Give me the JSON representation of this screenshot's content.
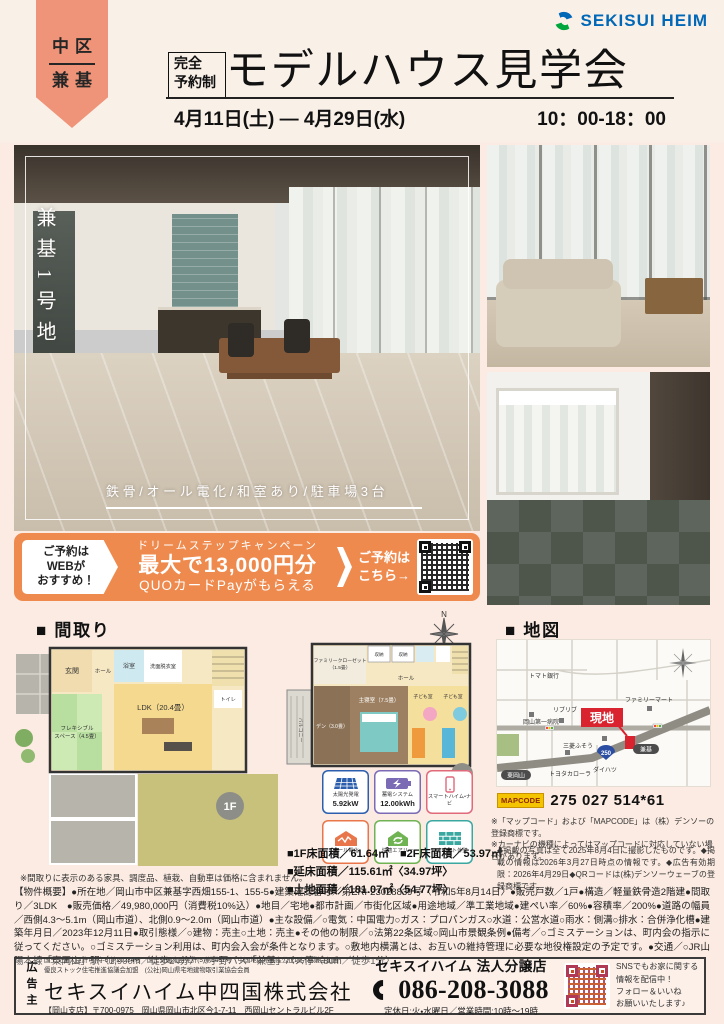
{
  "colors": {
    "accent_orange": "#ef8a4e",
    "ribbon": "#ef9478",
    "logo_blue": "#0068b7",
    "logo_green": "#00a63c",
    "map_red": "#d9232e",
    "mapcode_yellow": "#f5c400"
  },
  "header": {
    "area_badge": {
      "top": "中区",
      "bottom": "兼基"
    },
    "logo_text": "SEKISUI HEIM",
    "reserve_badge": {
      "top": "完全",
      "bottom": "予約制"
    },
    "title": "モデルハウス見学会",
    "date_range": "4月11日(土) ― 4月29日(水)",
    "time_range": "10：00-18：00"
  },
  "photos": {
    "site_label": "兼基1号地",
    "caption": "鉄骨/オール電化/和室あり/駐車場3台"
  },
  "campaign": {
    "web_lines": [
      "ご予約は",
      "WEBが",
      "おすすめ！"
    ],
    "subtitle": "ドリームステップキャンペーン",
    "headline": "最大で13,000円分",
    "subline": "QUOカードPayがもらえる",
    "cta_line1": "ご予約は",
    "cta_line2": "こちら→"
  },
  "madori": {
    "heading": "■ 間取り",
    "compass": "N",
    "f1": {
      "badge": "1F",
      "rooms": {
        "genkan": "玄関",
        "hall": "ホール",
        "bath": "浴室",
        "wash": "洗面脱衣室",
        "toilet": "トイレ",
        "ldk": "LDK（20.4畳）",
        "flex1": "フレキシブル",
        "flex2": "スペース（4.5畳）"
      }
    },
    "f2": {
      "badge": "2F",
      "rooms": {
        "balcony": "バルコニー",
        "fc1": "ファミリークローゼット",
        "fc2": "（1.5畳）",
        "den": "デン（3.0畳）",
        "bed": "主寝室（7.5畳）",
        "kids1": "子ども室",
        "kids2": "子ども室",
        "hall": "ホール",
        "closet1": "収納",
        "closet2": "収納"
      }
    },
    "features": [
      {
        "label": "太陽光発電",
        "value": "5.92kW"
      },
      {
        "label": "蓄電システム",
        "value": "12.00kWh"
      },
      {
        "label": "スマートハイム・ナビ",
        "value": ""
      },
      {
        "label": "オール電化",
        "value": ""
      },
      {
        "label": "快適エアリー",
        "value": ""
      },
      {
        "label": "ジオマイト外壁",
        "value": ""
      }
    ],
    "areas": [
      "■1F床面積／61.64㎡　■2F床面積／53.97㎡",
      "■延床面積／115.61㎡〈34.97坪〉",
      "■土地面積／181.07㎡〈54.77坪〉"
    ],
    "note": "※間取りに表示のある家具、調度品、植栽、自動車は価格に含まれません。"
  },
  "map": {
    "heading": "■ 地図",
    "labels": {
      "bank": "トマト銀行",
      "riburibu": "リブリブ",
      "famima": "ファミリーマート",
      "hospital": "岡山第一病院",
      "fuso": "三菱ふそう",
      "toyota": "トヨタカローラ",
      "daihatsu": "ダイハツ",
      "route": "250",
      "busstop": "兼基",
      "station": "東岡山",
      "genchi": "現地"
    },
    "mapcode_label": "MAPCODE",
    "mapcode": "275 027 514*61",
    "note1": "※「マップコード」および「MAPCODE」は（株）デンソーの登録商標です。",
    "note2": "※カーナビの機種によってはマップコードに対応していない場合があります。",
    "photo_note": "◆掲載の写真は全て2025年8月4日に撮影したものです。◆掲載の情報は2026年3月27日時点の情報です。◆広告有効期限：2026年4月29日◆QRコードは(株)デンソーウェーブの登録商標です。"
  },
  "outline": "【物件概要】●所在地／岡山市中区兼基字西畑155-1、155-5●建築確認番号／第ERI-23028839号〈令和5年8月14日〉●販売戸数／1戸●構造／軽量鉄骨造2階建●間取り／3LDK　●販売価格／49,980,000円（消費税10%込）●地目／宅地●都市計画／市街化区域●用途地域／準工業地域●建ぺい率／60%●容積率／200%●道路の幅員／西側4.3〜5.1m（岡山市道）、北側0.9〜2.0m（岡山市道）●主な設備／○電気：中国電力○ガス：プロパンガス○水道：公営水道○雨水：側溝○排水：合併浄化槽●建築年月日／2023年12月11日●取引態様／○建物：売主○土地：売主●その他の制限／○法第22条区域○岡山市景観条例●備考／○ゴミステーションは、町内会の指示に従ってください。○ゴミステーション利用は、町内会入会が条件となります。○敷地内横溝とは、お互いの維持管理に必要な地役権設定の予定です。●交通／○JR山陽本線「東岡山」駅〈1,900m／徒歩24分〉　○宇野バス「兼基」バス停〈80m／徒歩1分〉",
  "footer": {
    "advertiser": "広告主",
    "license1": "国土交通大臣許可(特-5)第20234号　国土交通大臣免許(5)第6461号　中国地区不動産公正取引協議会加盟",
    "license2": "優良ストック住宅推進協議会加盟　(公社)岡山県宅地建物取引業協会会員",
    "company": "セキスイハイム中四国株式会社",
    "branch": "【岡山支店】〒700-0975　岡山県岡山市北区今1-7-11　西岡山セントラルビル2F",
    "shop": "セキスイハイム 法人分譲店",
    "phone": "086-208-3088",
    "hours": "定休日:火・水曜日／営業時間:10時〜19時",
    "sns_lines": [
      "SNSでもお家に関する",
      "情報を配信中！",
      "フォロー＆いいね",
      "お願いいたします♪"
    ]
  }
}
